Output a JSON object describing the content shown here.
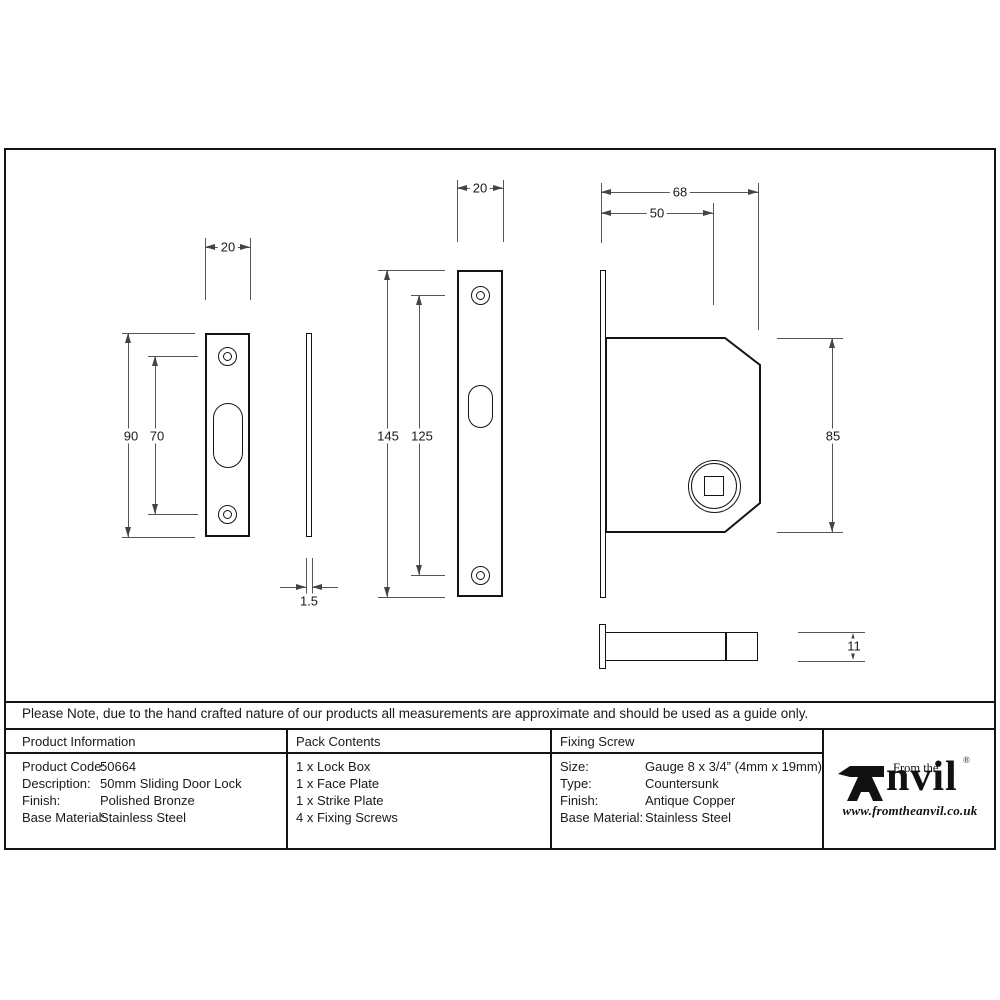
{
  "sheet": {
    "note": "Please Note, due to the hand crafted nature of our products all measurements are approximate and should be used as a guide only."
  },
  "table": {
    "product_information": {
      "header": "Product Information",
      "rows": [
        {
          "label": "Product Code:",
          "value": "50664"
        },
        {
          "label": "Description:",
          "value": "50mm Sliding Door Lock"
        },
        {
          "label": "Finish:",
          "value": "Polished Bronze"
        },
        {
          "label": "Base Material:",
          "value": "Stainless Steel"
        }
      ]
    },
    "pack_contents": {
      "header": "Pack Contents",
      "items": [
        "1 x Lock Box",
        "1 x Face Plate",
        "1 x Strike Plate",
        "4 x Fixing Screws"
      ]
    },
    "fixing_screw": {
      "header": "Fixing Screw",
      "rows": [
        {
          "label": "Size:",
          "value": "Gauge 8 x 3/4” (4mm x 19mm)"
        },
        {
          "label": "Type:",
          "value": "Countersunk"
        },
        {
          "label": "Finish:",
          "value": "Antique Copper"
        },
        {
          "label": "Base Material:",
          "value": "Stainless Steel"
        }
      ]
    }
  },
  "logo": {
    "from_the": "From the",
    "diamond": "♦",
    "brand": "Anvil",
    "brand_text": "nvil",
    "registered": "®",
    "website": "www.fromtheanvil.co.uk"
  },
  "drawings": {
    "strike_plate": {
      "width": "20",
      "height": "90",
      "screw_spacing": "70"
    },
    "strike_plate_side": {
      "thickness": "1.5"
    },
    "face_plate": {
      "width": "20",
      "height": "145",
      "screw_spacing": "125"
    },
    "lock_box": {
      "width": "68",
      "backset": "50",
      "height": "85"
    },
    "bolt": {
      "height": "11"
    }
  }
}
